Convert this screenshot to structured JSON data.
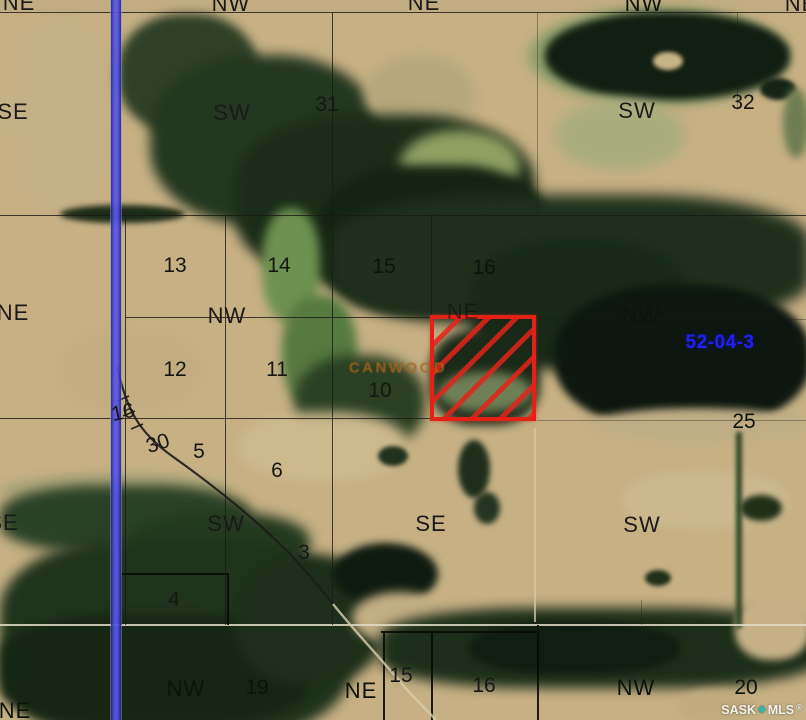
{
  "map": {
    "kind": "satellite-parcel-map",
    "region_label": "52-04-3",
    "rm_label": "CANWOOD",
    "watermark": {
      "left": "SASK",
      "diamond": "◆",
      "right": "MLS",
      "registered": "®"
    },
    "highlight_parcel": {
      "border_color": "#e42018",
      "hatch": "diagonal-red",
      "approx_location": "NE quarter, section 10 area"
    },
    "colors": {
      "road_overlay_blue": "#4646d8",
      "label_blue": "#2020f0",
      "label_orange": "#a8651c",
      "watermark_diamond": "#35b3a8",
      "parcel_red": "#e42018"
    },
    "labels": [
      {
        "t": "NE",
        "x": 19,
        "y": 3,
        "k": "q"
      },
      {
        "t": "NW",
        "x": 231,
        "y": 4,
        "k": "q"
      },
      {
        "t": "NE",
        "x": 424,
        "y": 3,
        "k": "q"
      },
      {
        "t": "NW",
        "x": 644,
        "y": 4,
        "k": "q qd"
      },
      {
        "t": "NE",
        "x": 801,
        "y": 4,
        "k": "q"
      },
      {
        "t": "SE",
        "x": 13,
        "y": 112,
        "k": "q"
      },
      {
        "t": "SW",
        "x": 232,
        "y": 113,
        "k": "q"
      },
      {
        "t": "31",
        "x": 327,
        "y": 105,
        "k": "s"
      },
      {
        "t": "SW",
        "x": 637,
        "y": 111,
        "k": "q"
      },
      {
        "t": "32",
        "x": 743,
        "y": 103,
        "k": "s"
      },
      {
        "t": "13",
        "x": 175,
        "y": 266,
        "k": "s"
      },
      {
        "t": "14",
        "x": 279,
        "y": 266,
        "k": "s"
      },
      {
        "t": "15",
        "x": 384,
        "y": 267,
        "k": "s sd"
      },
      {
        "t": "16",
        "x": 484,
        "y": 268,
        "k": "s sd"
      },
      {
        "t": "NE",
        "x": 13,
        "y": 313,
        "k": "q"
      },
      {
        "t": "NW",
        "x": 227,
        "y": 316,
        "k": "q"
      },
      {
        "t": "NE",
        "x": 463,
        "y": 312,
        "k": "q qd dim"
      },
      {
        "t": "NW",
        "x": 641,
        "y": 316,
        "k": "q qd"
      },
      {
        "t": "52-04-3",
        "x": 720,
        "y": 343,
        "k": "blue"
      },
      {
        "t": "12",
        "x": 175,
        "y": 370,
        "k": "s"
      },
      {
        "t": "11",
        "x": 277,
        "y": 370,
        "k": "s"
      },
      {
        "t": "CANWOOD",
        "x": 398,
        "y": 368,
        "k": "orange"
      },
      {
        "t": "10",
        "x": 380,
        "y": 391,
        "k": "s"
      },
      {
        "t": "16",
        "x": 123,
        "y": 413,
        "k": "s",
        "r": -12
      },
      {
        "t": "30",
        "x": 158,
        "y": 444,
        "k": "s",
        "r": -18
      },
      {
        "t": "5",
        "x": 199,
        "y": 452,
        "k": "s"
      },
      {
        "t": "6",
        "x": 277,
        "y": 471,
        "k": "s"
      },
      {
        "t": "25",
        "x": 744,
        "y": 422,
        "k": "s sd"
      },
      {
        "t": "SE",
        "x": 3,
        "y": 523,
        "k": "q"
      },
      {
        "t": "SW",
        "x": 226,
        "y": 524,
        "k": "q"
      },
      {
        "t": "SE",
        "x": 431,
        "y": 524,
        "k": "q"
      },
      {
        "t": "SW",
        "x": 642,
        "y": 525,
        "k": "q"
      },
      {
        "t": "3",
        "x": 304,
        "y": 553,
        "k": "s"
      },
      {
        "t": "4",
        "x": 174,
        "y": 600,
        "k": "s"
      },
      {
        "t": "15",
        "x": 401,
        "y": 676,
        "k": "s"
      },
      {
        "t": "16",
        "x": 484,
        "y": 686,
        "k": "s"
      },
      {
        "t": "NW",
        "x": 186,
        "y": 689,
        "k": "q qd"
      },
      {
        "t": "19",
        "x": 257,
        "y": 688,
        "k": "s sd"
      },
      {
        "t": "NE",
        "x": 361,
        "y": 691,
        "k": "q qd"
      },
      {
        "t": "NW",
        "x": 636,
        "y": 688,
        "k": "q qd"
      },
      {
        "t": "20",
        "x": 746,
        "y": 688,
        "k": "s sd"
      },
      {
        "t": "NE",
        "x": 15,
        "y": 711,
        "k": "q qd"
      }
    ]
  }
}
